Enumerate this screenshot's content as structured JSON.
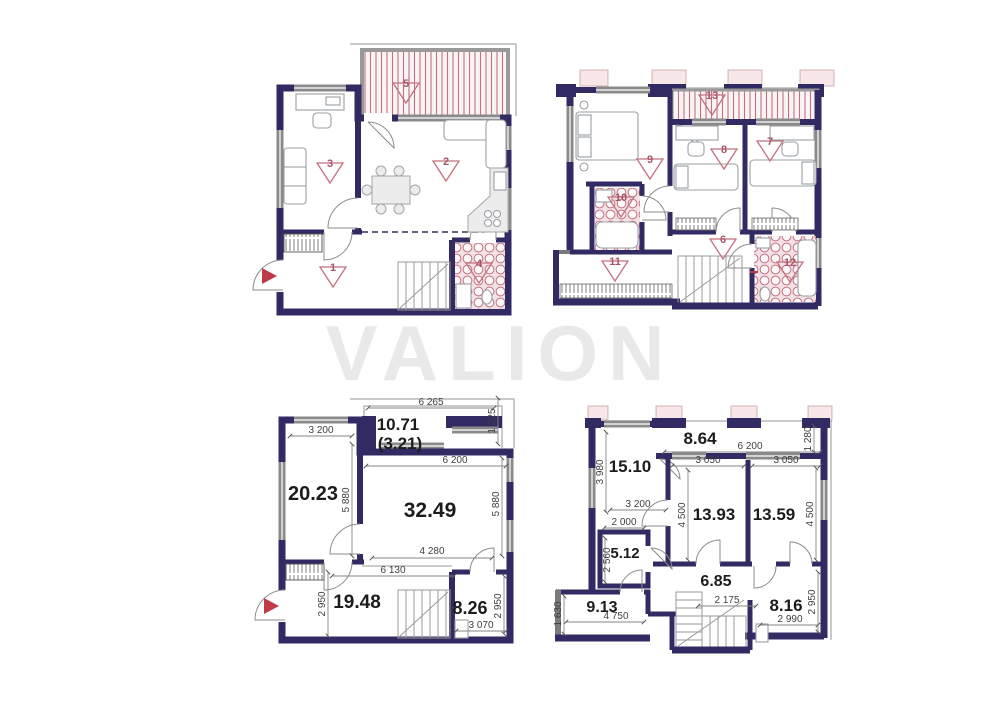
{
  "watermark": {
    "text": "VALION"
  },
  "colors": {
    "wall": "#322b63",
    "partition": "#7b7b7b",
    "accent": "#c4717e",
    "entry_arrow": "#c03a48",
    "watermark": "#e7e7e7"
  },
  "p1": {
    "m1": "1",
    "m2": "2",
    "m3": "3",
    "m4": "4",
    "m5": "5"
  },
  "p2": {
    "m6": "6",
    "m7": "7",
    "m8": "8",
    "m9": "9",
    "m10": "10",
    "m11": "11",
    "m12": "12",
    "m13": "13"
  },
  "p3": {
    "a_balcony": "10.71",
    "a_balcony2": "(3.21)",
    "a_left": "20.23",
    "a_living": "32.49",
    "a_hall": "19.48",
    "a_bath": "8.26",
    "d_6265": "6 265",
    "d_1225": "1 225",
    "d_3200": "3 200",
    "d_5880l": "5 880",
    "d_6200": "6 200",
    "d_5880r": "5 880",
    "d_4280": "4 280",
    "d_6130": "6 130",
    "d_2950l": "2 950",
    "d_3070": "3 070",
    "d_2950r": "2 950"
  },
  "p4": {
    "a_balcony": "8.64",
    "a_room1": "15.10",
    "a_room2": "13.93",
    "a_room3": "13.59",
    "a_wc": "5.12",
    "a_hall": "6.85",
    "a_loggia": "9.13",
    "a_bath": "8.16",
    "d_6200": "6 200",
    "d_1280": "1 280",
    "d_3980": "3 980",
    "d_3200": "3 200",
    "d_3050l": "3 050",
    "d_3050r": "3 050",
    "d_4500l": "4 500",
    "d_4500r": "4 500",
    "d_2000": "2 000",
    "d_2560": "2 560",
    "d_2175": "2 175",
    "d_4750": "4 750",
    "d_1630": "1 630",
    "d_2990": "2 990",
    "d_2950": "2 950"
  }
}
